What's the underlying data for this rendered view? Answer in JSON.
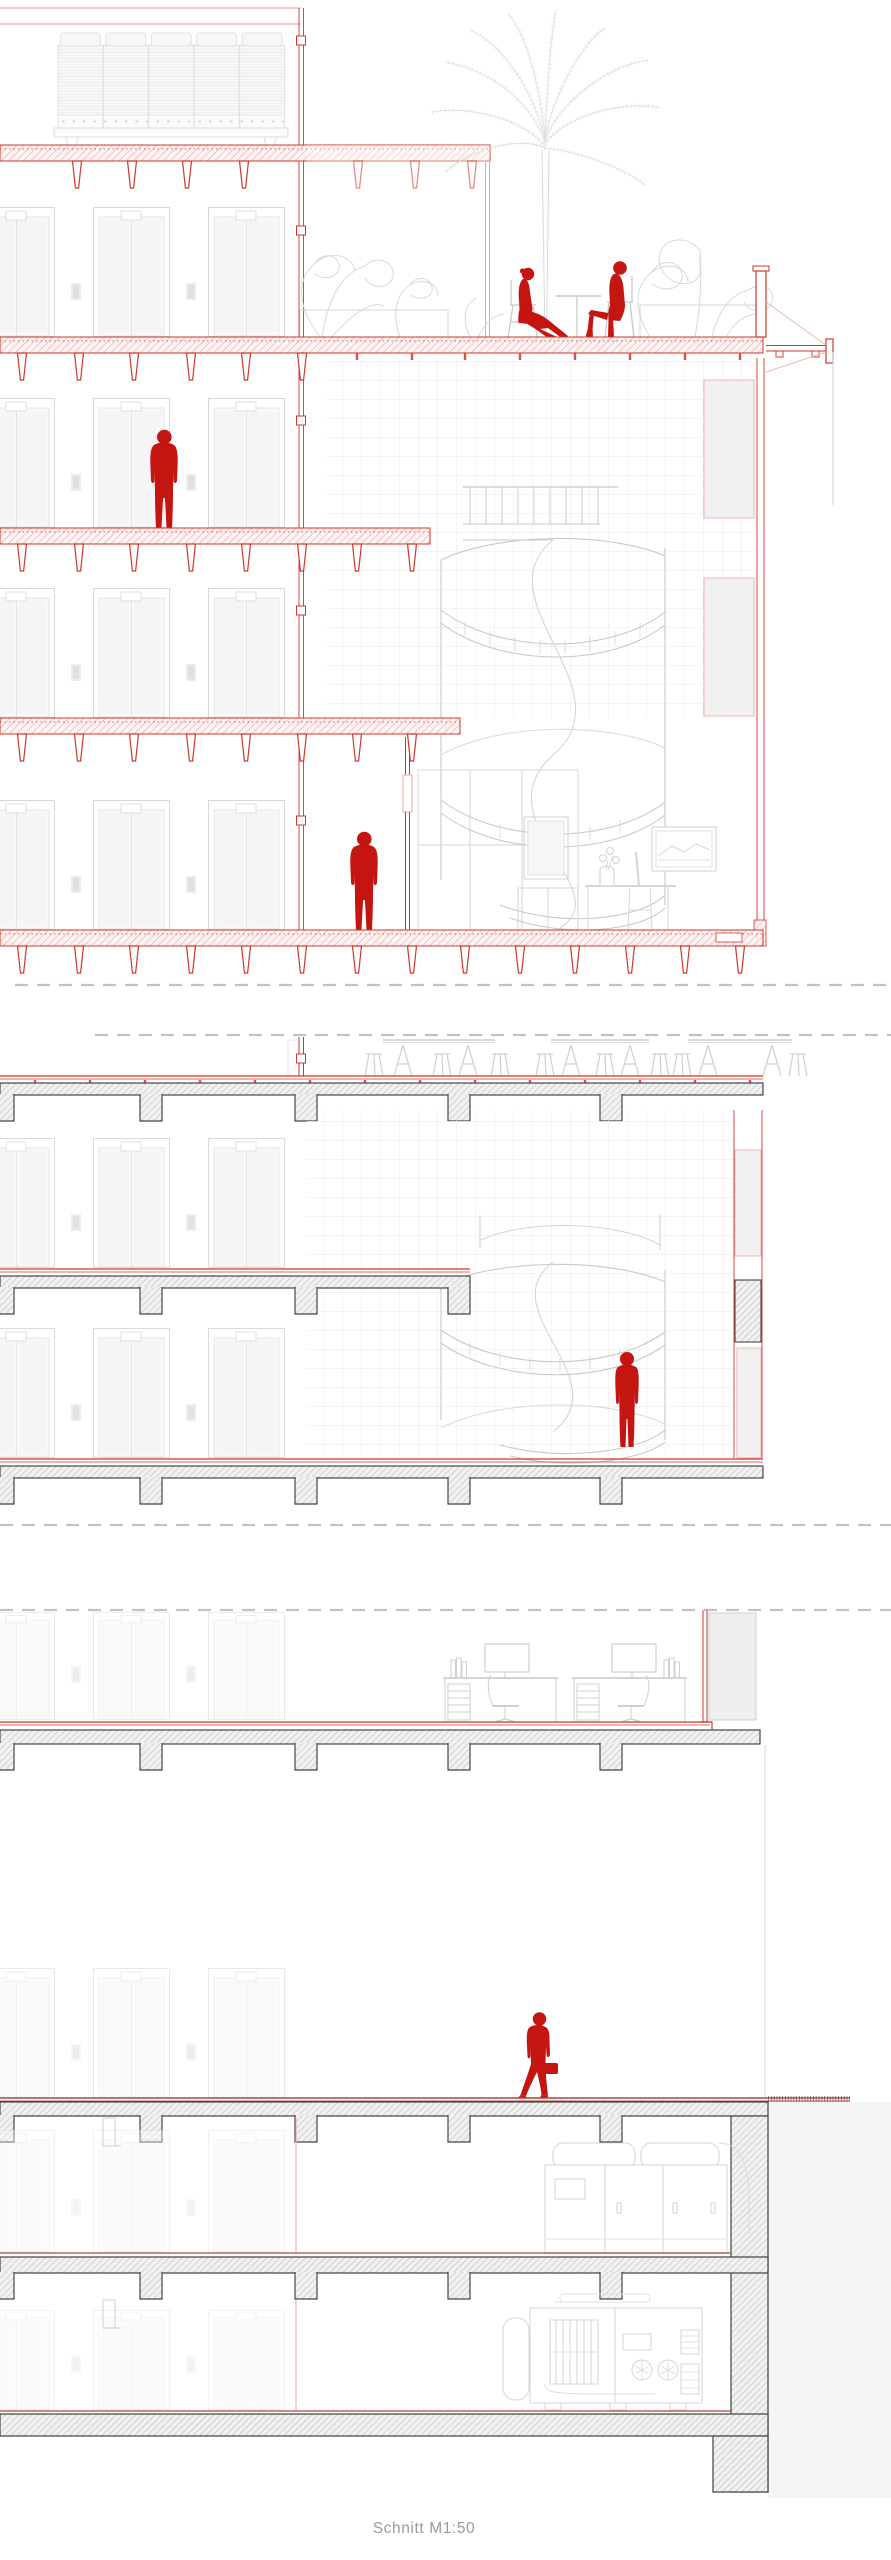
{
  "document": {
    "caption": "Schnitt M1:50",
    "drawing_type": "Schnitt",
    "scale": "M1:50"
  },
  "colors": {
    "accent_red": "#c41511",
    "structure_red": "#d0362e",
    "light_red": "#eb9d97",
    "pink_grid": "#f5e5e3",
    "drawing_gray": "#c9c9c9",
    "faint_gray": "#e2e2e2",
    "concrete_dark": "#454545",
    "ground_red": "#ad463e",
    "caption_gray": "#9a9a9a",
    "background": "#ffffff"
  },
  "figures": [
    {
      "id": "seated-woman-roof-terrace",
      "pose": "sitting"
    },
    {
      "id": "seated-man-roof-terrace",
      "pose": "sitting"
    },
    {
      "id": "standing-person-upper-floor",
      "pose": "standing"
    },
    {
      "id": "walking-person-corridor",
      "pose": "standing"
    },
    {
      "id": "person-on-spiral-stair",
      "pose": "standing"
    },
    {
      "id": "walking-person-ground-floor",
      "pose": "walking-with-briefcase"
    }
  ],
  "equipment": [
    {
      "id": "rooftop-chiller-unit"
    },
    {
      "id": "air-handling-unit-basement-1"
    },
    {
      "id": "generator-basement-2"
    }
  ]
}
